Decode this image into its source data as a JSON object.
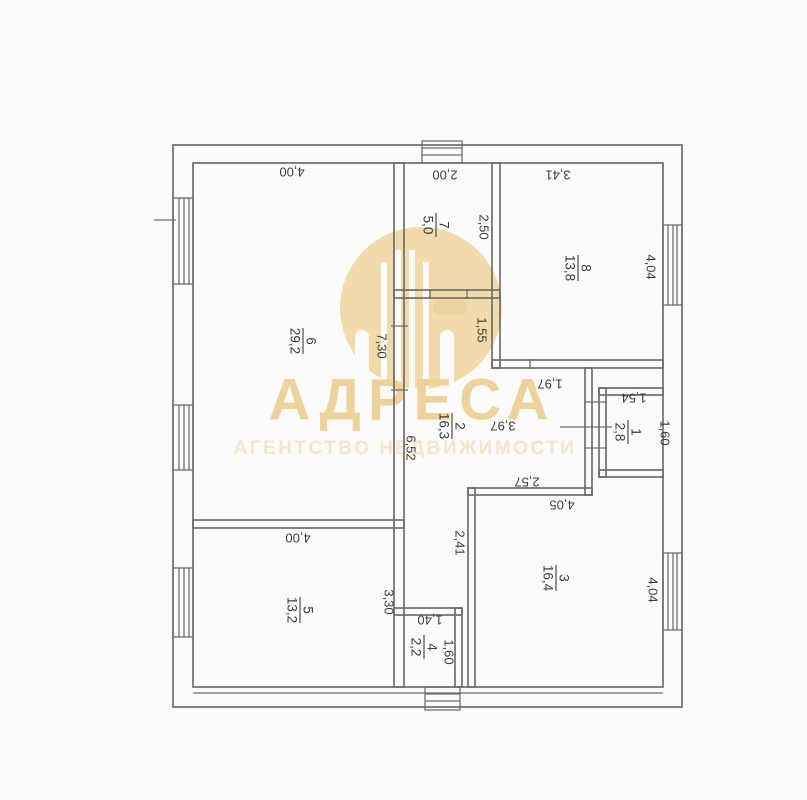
{
  "watermark": {
    "brand": "АДРЕСА",
    "subtitle": "АГЕНТСТВО НЕДВИЖИМОСТИ"
  },
  "rooms": {
    "r1": {
      "number": "1",
      "area": "2,8"
    },
    "r2": {
      "number": "2",
      "area": "16,3"
    },
    "r3": {
      "number": "3",
      "area": "16,4"
    },
    "r4": {
      "number": "4",
      "area": "2,2"
    },
    "r5": {
      "number": "5",
      "area": "13,2"
    },
    "r6": {
      "number": "6",
      "area": "29,2"
    },
    "r7": {
      "number": "7",
      "area": "5,0"
    },
    "r8": {
      "number": "8",
      "area": "13,8"
    }
  },
  "dims": {
    "room6_top": "4,00",
    "room7_top": "2,00",
    "room8_top": "3,41",
    "room7_right": "2,50",
    "room8_right": "4,04",
    "seg_155": "1,55",
    "room6_right": "7,30",
    "room2_left": "6,52",
    "seg_197": "1,97",
    "room2_width": "3,97",
    "room1_top": "1,54",
    "room1_right": "1,60",
    "seg_257": "2,57",
    "room3_top": "4,05",
    "room3_left": "2,41",
    "room3_right": "4,04",
    "room5_top": "4,00",
    "room5_right": "3,30",
    "room4_top": "1,40",
    "room4_right": "1,60"
  },
  "colors": {
    "line": "#6e6e6e",
    "ink": "#3c3c3c",
    "gold": "#f2dbaa",
    "gold-deep": "#eed29c",
    "gold-light": "#f4e6c7",
    "bg": "#fbfbf9"
  }
}
